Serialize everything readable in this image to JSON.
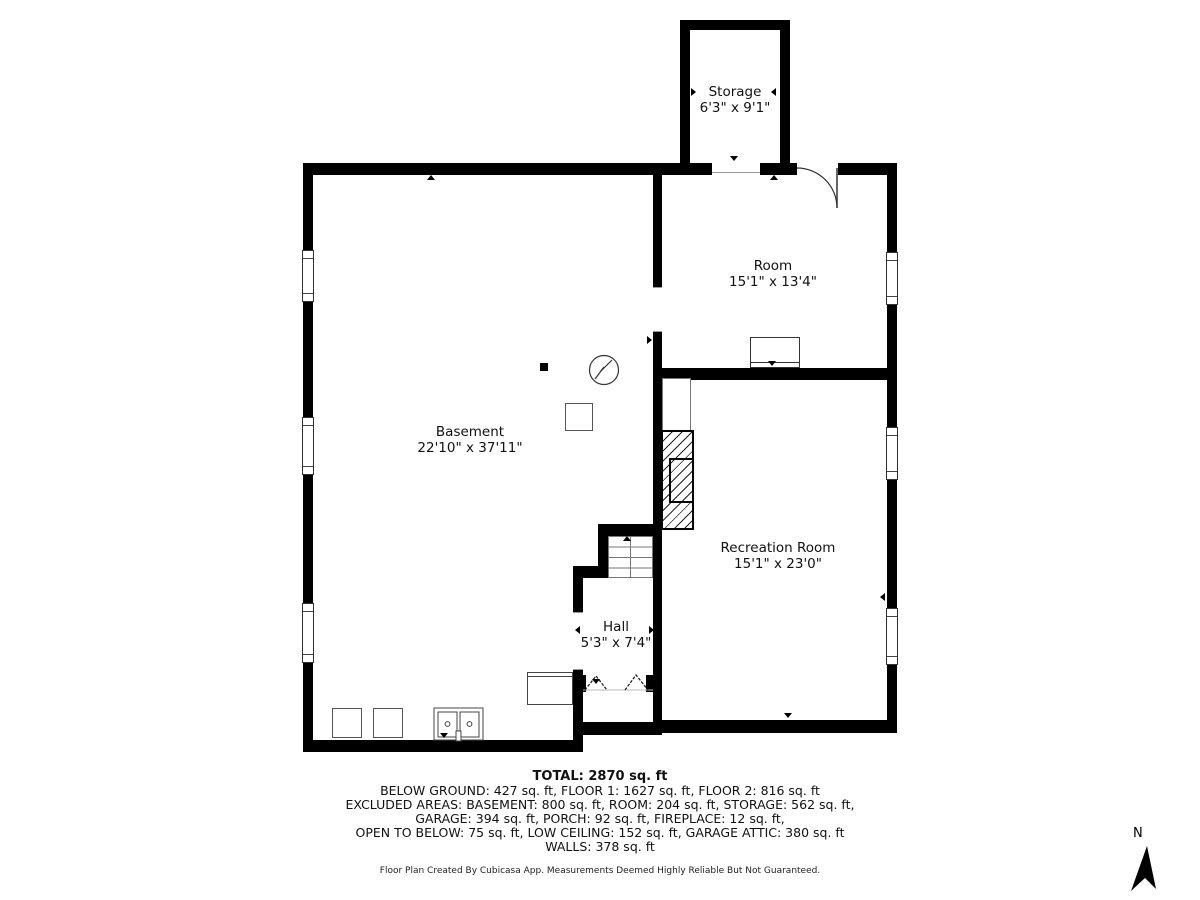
{
  "plan": {
    "rooms": [
      {
        "name": "Storage",
        "dims": "6'3\" x 9'1\""
      },
      {
        "name": "Room",
        "dims": "15'1\" x 13'4\""
      },
      {
        "name": "Basement",
        "dims": "22'10\" x 37'11\""
      },
      {
        "name": "Recreation Room",
        "dims": "15'1\" x 23'0\""
      },
      {
        "name": "Hall",
        "dims": "5'3\" x 7'4\""
      }
    ]
  },
  "summary": {
    "total": "TOTAL: 2870 sq. ft",
    "line1": "BELOW GROUND: 427 sq. ft, FLOOR 1: 1627 sq. ft, FLOOR 2: 816 sq. ft",
    "line2": "EXCLUDED AREAS: BASEMENT: 800 sq. ft, ROOM: 204 sq. ft, STORAGE: 562 sq. ft,",
    "line3": "GARAGE: 394 sq. ft, PORCH: 92 sq. ft, FIREPLACE: 12 sq. ft,",
    "line4": "OPEN TO BELOW: 75 sq. ft, LOW CEILING: 152 sq. ft, GARAGE ATTIC: 380 sq. ft",
    "line5": "WALLS: 378 sq. ft"
  },
  "footer": {
    "credit": "Floor Plan Created By Cubicasa App. Measurements Deemed Highly Reliable But Not Guaranteed."
  },
  "compass": {
    "label": "N"
  },
  "colors": {
    "wall": "#000000",
    "background": "#ffffff",
    "text": "#1a1a1a"
  }
}
